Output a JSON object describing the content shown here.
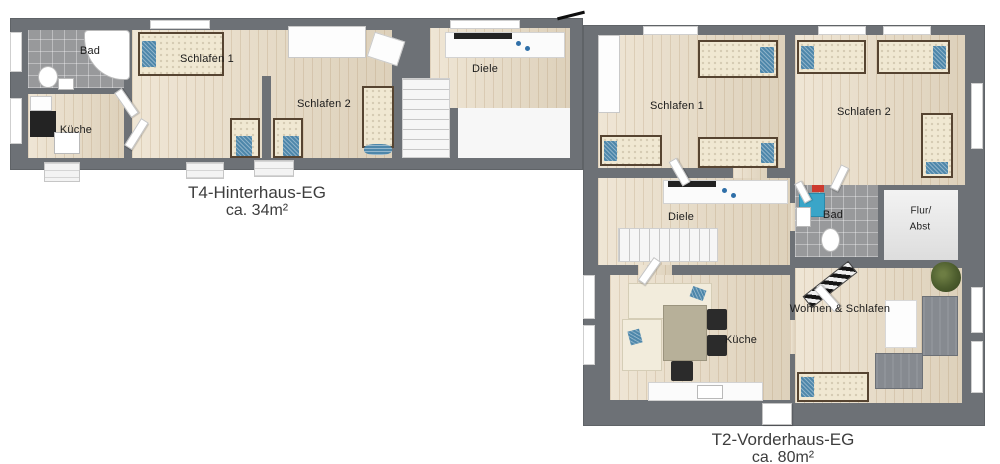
{
  "colors": {
    "wall": "#6d7176",
    "wood_floor": "#e9dcc5",
    "tile_floor": "#98999b",
    "accent_blue": "#4e87aa",
    "sofa_grey": "#868a90",
    "text": "#3d3d3d"
  },
  "hinterhaus": {
    "title": "T4-Hinterhaus-EG",
    "area": "ca. 34m²",
    "rooms": {
      "bad": "Bad",
      "kueche": "Küche",
      "schlafen1": "Schlafen 1",
      "schlafen2": "Schlafen 2",
      "diele": "Diele"
    }
  },
  "vorderhaus": {
    "title": "T2-Vorderhaus-EG",
    "area": "ca. 80m²",
    "rooms": {
      "schlafen1": "Schlafen 1",
      "schlafen2": "Schlafen 2",
      "diele": "Diele",
      "bad": "Bad",
      "flur_line1": "Flur/",
      "flur_line2": "Abst",
      "kueche": "Küche",
      "wohnen": "Wohnen & Schlafen"
    }
  }
}
